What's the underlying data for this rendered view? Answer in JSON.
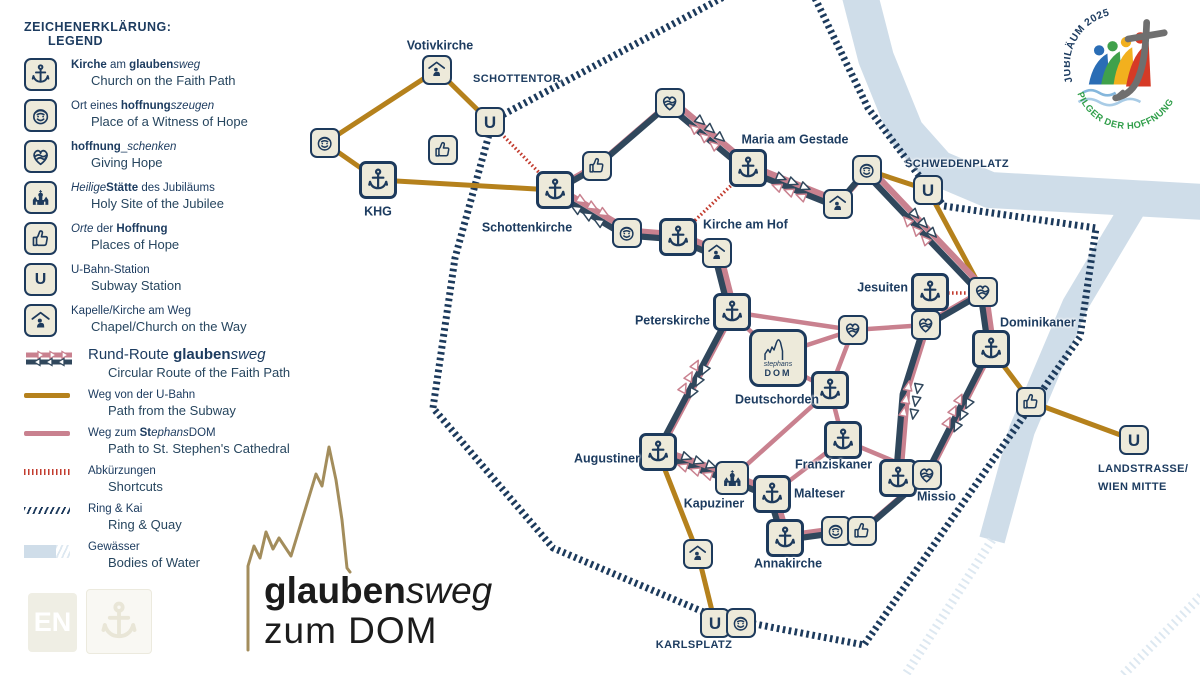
{
  "lang_badge": "EN",
  "title": {
    "glauben": "glauben",
    "sweg": "sweg",
    "zum_dom": "zum DOM"
  },
  "logo": {
    "top_arc": "JUBILÄUM 2025",
    "bottom_arc": "PILGER DER HOFFNUNG",
    "colors": {
      "blue": "#2a6db5",
      "green": "#3fa14b",
      "yellow": "#f2b01e",
      "red": "#d63a26",
      "cross_grey": "#6f6f6f",
      "wave_blue": "#85b7dc",
      "arc_green": "#2f9e49",
      "arc_navy": "#1d3c60"
    }
  },
  "legend": {
    "title_de": "ZEICHENERKLÄRUNG:",
    "title_en": "LEGEND",
    "items": [
      {
        "icon": "kirche",
        "de": [
          {
            "t": "Kirche",
            "b": true
          },
          {
            "t": " am "
          },
          {
            "t": "glauben",
            "b": true
          },
          {
            "t": "sweg",
            "i": true
          }
        ],
        "en": "Church on the Faith Path"
      },
      {
        "icon": "smiley",
        "de": [
          {
            "t": "Ort eines "
          },
          {
            "t": "hoffnung",
            "b": true
          },
          {
            "t": "szeugen",
            "i": true
          }
        ],
        "en": "Place of a Witness of Hope"
      },
      {
        "icon": "heart",
        "de": [
          {
            "t": "hoffnung",
            "b": true
          },
          {
            "t": "_"
          },
          {
            "t": "schenken",
            "i": true
          }
        ],
        "en": "Giving Hope"
      },
      {
        "icon": "church",
        "de": [
          {
            "t": "Heilige",
            "i": true
          },
          {
            "t": "Stätte",
            "b": true
          },
          {
            "t": " des Jubiläums"
          }
        ],
        "en": "Holy Site of the Jubilee"
      },
      {
        "icon": "thumbs",
        "de": [
          {
            "t": "Orte",
            "i": true
          },
          {
            "t": " der "
          },
          {
            "t": "Hoffnung",
            "b": true
          }
        ],
        "en": "Places of Hope"
      },
      {
        "icon": "ubahn",
        "de": [
          {
            "t": "U-Bahn-Station"
          }
        ],
        "en": "Subway Station"
      },
      {
        "icon": "chapel",
        "de": [
          {
            "t": "Kapelle/Kirche am Weg"
          }
        ],
        "en": "Chapel/Church on the Way"
      }
    ],
    "routes": [
      {
        "swatch": "rund",
        "big": true,
        "de": [
          {
            "t": "Rund-Route "
          },
          {
            "t": "glauben",
            "b": true
          },
          {
            "t": "sweg",
            "i": true
          }
        ],
        "en": "Circular Route of the Faith Path"
      },
      {
        "swatch": "ubahn",
        "big": false,
        "de": [
          {
            "t": "Weg von der U-Bahn"
          }
        ],
        "en": "Path from the Subway"
      },
      {
        "swatch": "dom",
        "big": false,
        "de": [
          {
            "t": "Weg zum "
          },
          {
            "t": "St",
            "b": true
          },
          {
            "t": "ephans",
            "i": true
          },
          {
            "t": "DOM"
          }
        ],
        "en": "Path to St. Stephen's Cathedral"
      },
      {
        "swatch": "short",
        "big": false,
        "de": [
          {
            "t": "Abkürzungen"
          }
        ],
        "en": "Shortcuts"
      },
      {
        "swatch": "ring",
        "big": false,
        "de": [
          {
            "t": "Ring & Kai"
          }
        ],
        "en": "Ring & Quay"
      },
      {
        "swatch": "water",
        "big": false,
        "de": [
          {
            "t": "Gewässer"
          }
        ],
        "en": "Bodies of Water"
      }
    ]
  },
  "map": {
    "u_letter": "U",
    "dom_icon": {
      "line1": "stephans",
      "line2": "DOM"
    },
    "colors": {
      "navy": "#1d3a5c",
      "route_navy": "#30475c",
      "pink": "#c9818f",
      "ochre": "#b5811c",
      "red": "#c23b2e",
      "water": "#cfdde9",
      "water_hatch": "#dde8f1",
      "ring": "#1c3a5c",
      "cream": "#edeada",
      "gold": "#a38d5c"
    },
    "water": [
      {
        "pts": [
          [
            858,
            -12
          ],
          [
            876,
            58
          ],
          [
            906,
            132
          ],
          [
            938,
            168
          ],
          [
            990,
            190
          ],
          [
            1205,
            202
          ]
        ],
        "w": 36
      },
      {
        "pts": [
          [
            1140,
            196
          ],
          [
            1075,
            305
          ],
          [
            1022,
            430
          ],
          [
            992,
            540
          ]
        ],
        "w": 26
      }
    ],
    "water_hatch": [
      {
        "pts": [
          [
            992,
            540
          ],
          [
            906,
            674
          ]
        ]
      },
      {
        "pts": [
          [
            1205,
            592
          ],
          [
            1122,
            676
          ]
        ]
      }
    ],
    "ring": [
      [
        733,
        -8
      ],
      [
        493,
        120
      ],
      [
        455,
        258
      ],
      [
        433,
        408
      ],
      [
        553,
        548
      ],
      [
        713,
        616
      ],
      [
        864,
        645
      ],
      [
        1000,
        450
      ],
      [
        1080,
        337
      ],
      [
        1096,
        228
      ],
      [
        944,
        206
      ],
      [
        916,
        172
      ],
      [
        868,
        108
      ],
      [
        812,
        -8
      ]
    ],
    "ochre_paths": [
      [
        [
          325,
          143
        ],
        [
          437,
          70
        ],
        [
          490,
          122
        ]
      ],
      [
        [
          325,
          143
        ],
        [
          378,
          180
        ],
        [
          553,
          190
        ]
      ],
      [
        [
          867,
          170
        ],
        [
          928,
          190
        ],
        [
          983,
          292
        ]
      ],
      [
        [
          991,
          349
        ],
        [
          1031,
          402
        ],
        [
          1134,
          440
        ]
      ],
      [
        [
          658,
          452
        ],
        [
          698,
          554
        ],
        [
          715,
          623
        ]
      ]
    ],
    "pink_links": [
      [
        736,
        318,
        758,
        338
      ],
      [
        732,
        312,
        853,
        330
      ],
      [
        792,
        350,
        853,
        330
      ],
      [
        853,
        330,
        926,
        325
      ],
      [
        800,
        374,
        830,
        390
      ],
      [
        830,
        390,
        853,
        330
      ],
      [
        830,
        390,
        843,
        440
      ],
      [
        830,
        390,
        732,
        478
      ],
      [
        843,
        440,
        927,
        475
      ],
      [
        843,
        440,
        772,
        494
      ]
    ],
    "shortcuts": [
      [
        [
          490,
          122
        ],
        [
          552,
          186
        ]
      ],
      [
        [
          745,
          172
        ],
        [
          682,
          233
        ]
      ],
      [
        [
          948,
          293
        ],
        [
          966,
          293
        ]
      ]
    ],
    "routes": {
      "loop": [
        [
          555,
          190
        ],
        [
          597,
          166
        ],
        [
          670,
          103
        ],
        [
          748,
          168
        ],
        [
          838,
          204
        ],
        [
          867,
          170
        ],
        [
          983,
          292
        ],
        [
          991,
          349
        ],
        [
          927,
          475
        ],
        [
          862,
          531
        ],
        [
          836,
          531
        ],
        [
          785,
          538
        ],
        [
          772,
          494
        ],
        [
          732,
          478
        ],
        [
          658,
          452
        ],
        [
          732,
          312
        ],
        [
          717,
          253
        ],
        [
          678,
          237
        ],
        [
          627,
          233
        ],
        [
          555,
          190
        ]
      ],
      "inner": [
        [
          983,
          292
        ],
        [
          926,
          325
        ],
        [
          905,
          392
        ],
        [
          898,
          478
        ]
      ]
    },
    "arrows": [
      [
        707,
        133,
        40
      ],
      [
        791,
        187,
        22
      ],
      [
        920,
        227,
        47
      ],
      [
        911,
        400,
        100
      ],
      [
        958,
        413,
        117
      ],
      [
        697,
        466,
        19
      ],
      [
        694,
        379,
        118
      ],
      [
        590,
        211,
        -150
      ]
    ],
    "cathedral_path": "M248,650 L248,566 L254,546 L260,558 L266,532 L273,549 L279,538 L291,556 L316,474 L322,486 L329,447 L336,480 L342,520 L347,568 L350,572",
    "nodes": [
      {
        "id": "votivkirche",
        "type": "chapel",
        "x": 437,
        "y": 70
      },
      {
        "id": "schottentor-u",
        "type": "ubahn",
        "x": 490,
        "y": 122
      },
      {
        "id": "witness-alsergrund",
        "type": "smiley",
        "x": 325,
        "y": 143
      },
      {
        "id": "hope-place-1",
        "type": "thumbs",
        "x": 443,
        "y": 150
      },
      {
        "id": "khg",
        "type": "kirche",
        "x": 378,
        "y": 180
      },
      {
        "id": "schottenkirche",
        "type": "kirche",
        "x": 555,
        "y": 190
      },
      {
        "id": "hope-place-2",
        "type": "thumbs",
        "x": 597,
        "y": 166
      },
      {
        "id": "heart-1",
        "type": "heart",
        "x": 670,
        "y": 103
      },
      {
        "id": "maria-am-gestade",
        "type": "kirche",
        "x": 748,
        "y": 168
      },
      {
        "id": "chapel-gestade",
        "type": "chapel",
        "x": 838,
        "y": 204
      },
      {
        "id": "witness-schwedenplatz",
        "type": "smiley",
        "x": 867,
        "y": 170
      },
      {
        "id": "schwedenplatz-u",
        "type": "ubahn",
        "x": 928,
        "y": 190
      },
      {
        "id": "witness-am-hof",
        "type": "smiley",
        "x": 627,
        "y": 233
      },
      {
        "id": "kirche-am-hof",
        "type": "kirche",
        "x": 678,
        "y": 237
      },
      {
        "id": "chapel-am-hof",
        "type": "chapel",
        "x": 717,
        "y": 253
      },
      {
        "id": "jesuiten",
        "type": "kirche",
        "x": 930,
        "y": 292
      },
      {
        "id": "heart-dominikaner",
        "type": "heart",
        "x": 983,
        "y": 292
      },
      {
        "id": "heart-jesuiten",
        "type": "heart",
        "x": 926,
        "y": 325
      },
      {
        "id": "dominikaner",
        "type": "kirche",
        "x": 991,
        "y": 349
      },
      {
        "id": "peterskirche",
        "type": "kirche",
        "x": 732,
        "y": 312
      },
      {
        "id": "heart-stephansplatz",
        "type": "heart",
        "x": 853,
        "y": 330
      },
      {
        "id": "stephansdom",
        "type": "dom",
        "x": 778,
        "y": 358
      },
      {
        "id": "deutschorden",
        "type": "kirche",
        "x": 830,
        "y": 390
      },
      {
        "id": "franziskaner",
        "type": "kirche",
        "x": 843,
        "y": 440
      },
      {
        "id": "hope-place-3",
        "type": "thumbs",
        "x": 1031,
        "y": 402
      },
      {
        "id": "landstrasse-u",
        "type": "ubahn",
        "x": 1134,
        "y": 440
      },
      {
        "id": "augustiner",
        "type": "kirche",
        "x": 658,
        "y": 452
      },
      {
        "id": "kapuziner",
        "type": "church",
        "x": 732,
        "y": 478
      },
      {
        "id": "malteser",
        "type": "kirche",
        "x": 772,
        "y": 494
      },
      {
        "id": "missio",
        "type": "kirche",
        "x": 898,
        "y": 478
      },
      {
        "id": "heart-missio",
        "type": "heart",
        "x": 927,
        "y": 475
      },
      {
        "id": "annakirche",
        "type": "kirche",
        "x": 785,
        "y": 538
      },
      {
        "id": "witness-anna",
        "type": "smiley",
        "x": 836,
        "y": 531
      },
      {
        "id": "hope-place-4",
        "type": "thumbs",
        "x": 862,
        "y": 531
      },
      {
        "id": "chapel-wieden",
        "type": "chapel",
        "x": 698,
        "y": 554
      },
      {
        "id": "karlsplatz-u",
        "type": "ubahn",
        "x": 715,
        "y": 623
      },
      {
        "id": "witness-karlsplatz",
        "type": "smiley",
        "x": 741,
        "y": 623
      }
    ],
    "labels": [
      {
        "id": "votivkirche",
        "text": "Votivkirche",
        "x": 440,
        "y": 46,
        "align": "c",
        "caps": false
      },
      {
        "id": "schottentor",
        "text": "SCHOTTENTOR",
        "x": 517,
        "y": 80,
        "align": "c",
        "caps": true
      },
      {
        "id": "khg",
        "text": "KHG",
        "x": 378,
        "y": 212,
        "align": "c",
        "caps": false
      },
      {
        "id": "schottenkirche",
        "text": "Schottenkirche",
        "x": 527,
        "y": 228,
        "align": "c",
        "caps": false
      },
      {
        "id": "maria-am-gestade",
        "text": "Maria am Gestade",
        "x": 795,
        "y": 140,
        "align": "c",
        "caps": false
      },
      {
        "id": "schwedenplatz",
        "text": "SCHWEDENPLATZ",
        "x": 957,
        "y": 165,
        "align": "c",
        "caps": true
      },
      {
        "id": "kirche-am-hof",
        "text": "Kirche am Hof",
        "x": 703,
        "y": 225,
        "align": "l",
        "caps": false
      },
      {
        "id": "jesuiten",
        "text": "Jesuiten",
        "x": 908,
        "y": 288,
        "align": "r",
        "caps": false
      },
      {
        "id": "dominikaner",
        "text": "Dominikaner",
        "x": 1000,
        "y": 323,
        "align": "l",
        "caps": false
      },
      {
        "id": "peterskirche",
        "text": "Peterskirche",
        "x": 710,
        "y": 321,
        "align": "r",
        "caps": false
      },
      {
        "id": "deutschorden",
        "text": "Deutschorden",
        "x": 735,
        "y": 400,
        "align": "l",
        "caps": false
      },
      {
        "id": "franziskaner",
        "text": "Franziskaner",
        "x": 795,
        "y": 465,
        "align": "l",
        "caps": false
      },
      {
        "id": "augustiner",
        "text": "Augustiner",
        "x": 640,
        "y": 459,
        "align": "r",
        "caps": false
      },
      {
        "id": "kapuziner",
        "text": "Kapuziner",
        "x": 714,
        "y": 504,
        "align": "c",
        "caps": false
      },
      {
        "id": "malteser",
        "text": "Malteser",
        "x": 794,
        "y": 494,
        "align": "l",
        "caps": false
      },
      {
        "id": "annakirche",
        "text": "Annakirche",
        "x": 788,
        "y": 564,
        "align": "c",
        "caps": false
      },
      {
        "id": "missio",
        "text": "Missio",
        "x": 917,
        "y": 497,
        "align": "l",
        "caps": false
      },
      {
        "id": "karlsplatz",
        "text": "KARLSPLATZ",
        "x": 694,
        "y": 646,
        "align": "c",
        "caps": true
      },
      {
        "id": "landstrasse-1",
        "text": "LANDSTRASSE/",
        "x": 1098,
        "y": 470,
        "align": "l",
        "caps": true
      },
      {
        "id": "landstrasse-2",
        "text": "WIEN MITTE",
        "x": 1098,
        "y": 488,
        "align": "l",
        "caps": true
      }
    ]
  }
}
